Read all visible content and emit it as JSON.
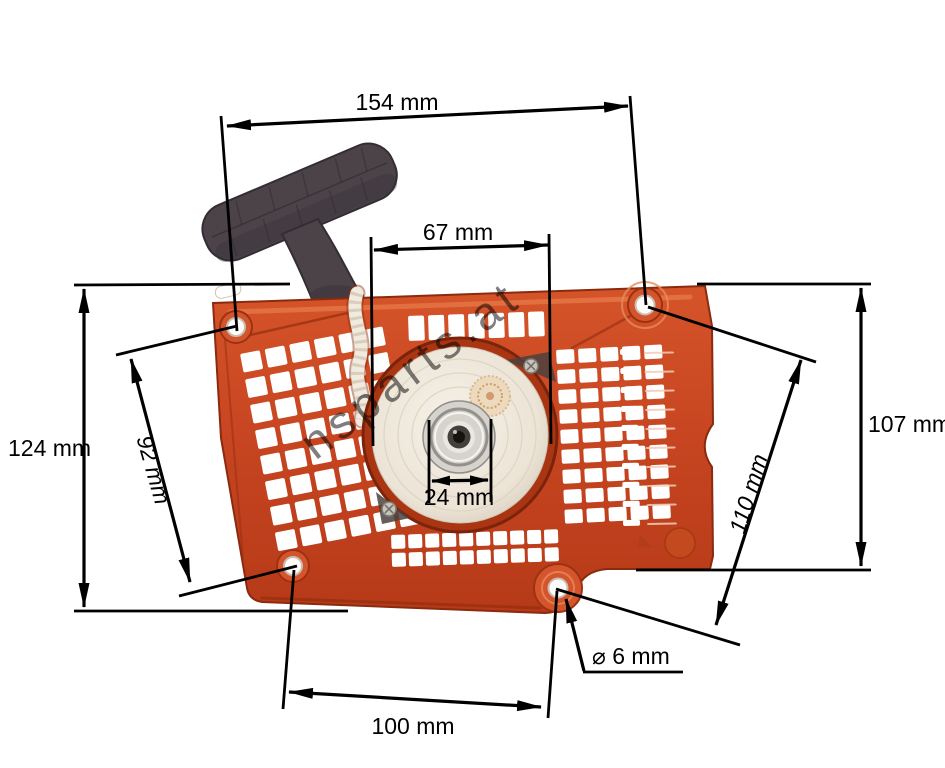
{
  "image": {
    "background": "#ffffff"
  },
  "product": {
    "body_color": "#c64420",
    "body_shadow_color": "#8a2a0e",
    "body_highlight_color": "#e77a48",
    "handle_color": "#4c4349",
    "pulley_color": "#ece4d6",
    "hub_color": "#d6d3cd",
    "rope_color": "#f0eadf"
  },
  "watermark": {
    "text": "nsparts.at",
    "color": "#cfa49b"
  },
  "dimensions": {
    "overall_width": {
      "label": "154 mm"
    },
    "pulley_housing_width": {
      "label": "67 mm"
    },
    "overall_height": {
      "label": "124 mm"
    },
    "left_hole_spacing": {
      "label": "92 mm"
    },
    "right_height": {
      "label": "107 mm"
    },
    "diagonal_hole_spacing": {
      "label": "110 mm"
    },
    "bottom_hole_spacing": {
      "label": "100 mm"
    },
    "hub_diameter": {
      "label": "24 mm"
    },
    "mount_hole_diameter": {
      "label": "⌀ 6 mm"
    }
  }
}
